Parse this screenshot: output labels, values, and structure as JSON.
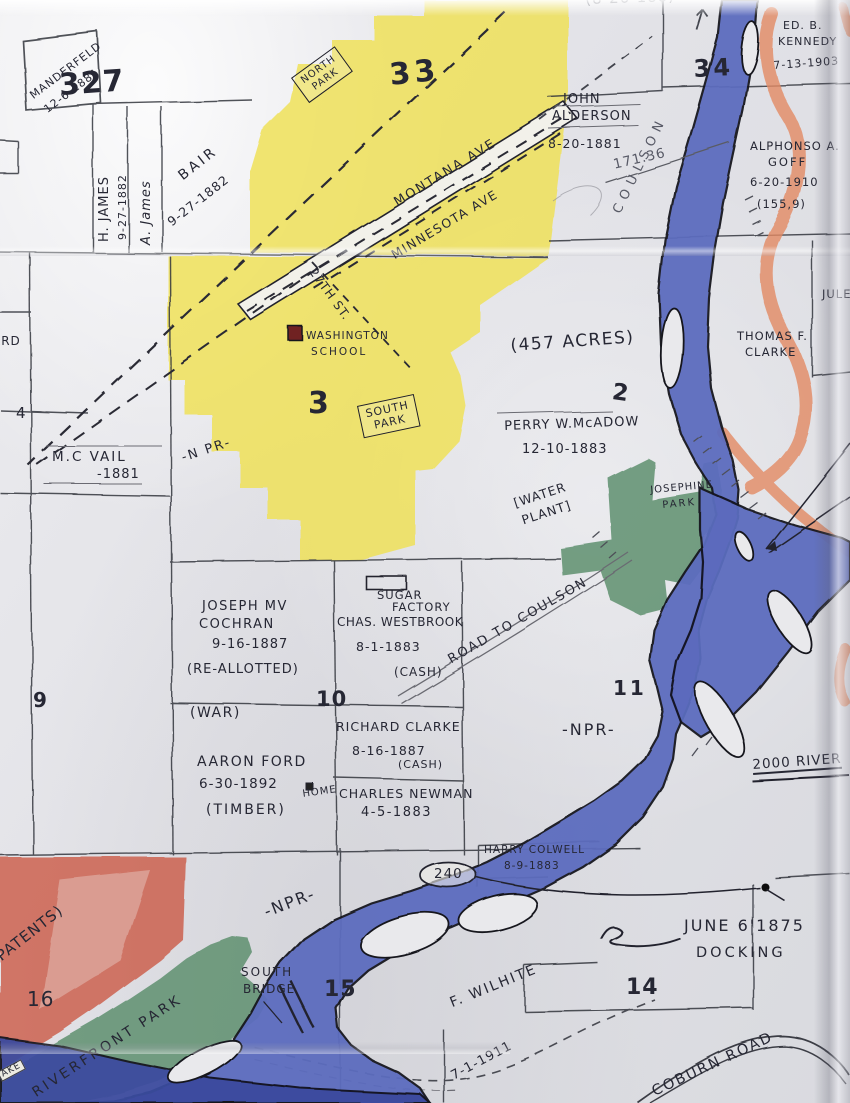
{
  "colors": {
    "water": "#5c6cbe",
    "water_dark": "#3c4b9f",
    "park_green": "#5d8f6f",
    "city_yellow": "#efe052",
    "patent_red": "#cb5743",
    "bluff_orange": "#e69070",
    "school_maroon": "#6f2222",
    "ink": "#262734"
  },
  "sections": {
    "s32": "327",
    "s33": "33",
    "s34": "34",
    "s3": "3",
    "s2": "2",
    "s4": "4",
    "s9": "9",
    "s10": "10",
    "s11": "11",
    "s14": "14",
    "s15": "15",
    "s16": "16"
  },
  "parks": {
    "north1": "NORTH",
    "north2": "PARK",
    "south1": "SOUTH",
    "south2": "PARK",
    "jos1": "JOSEPHINE",
    "jos2": "PARK",
    "riverfront": "RIVERFRONT PARK"
  },
  "streets": {
    "montana": "MONTANA AVE",
    "minnesota": "MINNESOTA AVE",
    "st27": "27TH ST.",
    "road_coulson": "ROAD TO COULSON",
    "coulson": "COULSON",
    "coburn": "COBURN ROAD",
    "npr_nw": "-N PR-",
    "npr_mid": "-NPR-",
    "npr_sw": "-NPR-"
  },
  "owners": {
    "manderfeld": {
      "name": "MANDERFELD",
      "date": "12-6-1881"
    },
    "h_james": {
      "name": "H. JAMES",
      "date": "9-27-1882"
    },
    "a_james": {
      "name": "A. James"
    },
    "bair": {
      "name": "BAIR",
      "date": "9-27-1882"
    },
    "alderson": {
      "name1": "JOHN",
      "name2": "ALDERSON",
      "date": "8-20-1881"
    },
    "kennedy": {
      "name1": "ED. B.",
      "name2": "KENNEDY",
      "date": "7-13-1903"
    },
    "goff": {
      "name1": "ALPHONSO A.",
      "name2": "GOFF",
      "date": "6-20-1910",
      "acres": "(155,9)"
    },
    "thomas_clarke": {
      "name1": "THOMAS F.",
      "name2": "CLARKE"
    },
    "vail": {
      "name": "M.C VAIL",
      "date": "-1881"
    },
    "mcadow": {
      "name": "PERRY W.McADOW",
      "date": "12-10-1883"
    },
    "cochran": {
      "name1": "JOSEPH MV",
      "name2": "COCHRAN",
      "date": "9-16-1887",
      "note": "(RE-ALLOTTED)"
    },
    "westbrook": {
      "name": "CHAS. WESTBROOK",
      "date": "8-1-1883",
      "note": "(CASH)"
    },
    "richard_clarke": {
      "name": "RICHARD CLARKE",
      "date": "8-16-1887",
      "note": "(CASH)"
    },
    "ford": {
      "name": "AARON FORD",
      "date": "6-30-1892",
      "note": "(TIMBER)",
      "home": "HOME"
    },
    "newman": {
      "name": "CHARLES NEWMAN",
      "date": "4-5-1883"
    },
    "colwell": {
      "name": "HARRY COLWELL",
      "date": "8-9-1883"
    },
    "wilhite": {
      "name": "F. WILHITE"
    },
    "jules": {
      "name": "JULES"
    }
  },
  "sites": {
    "school1": "WASHINGTON",
    "school2": "SCHOOL",
    "sugar1": "SUGAR",
    "sugar2": "FACTORY",
    "water1": "[WATER",
    "water2": "PLANT]"
  },
  "notes": {
    "acres457": "(457 ACRES)",
    "survey": "171.36",
    "war": "(WAR)",
    "dock1": "JUNE 6'1875",
    "dock2": "DOCKING",
    "bridge1": "SOUTH",
    "bridge2": "BRIDGE",
    "lot240": "240",
    "river2000": "2000 RIVER",
    "d1911": "7-1-1911",
    "patents": "PATENTS)",
    "ard": "ARD",
    "lake": "AKE",
    "edge_top": "(8-26-188)"
  }
}
